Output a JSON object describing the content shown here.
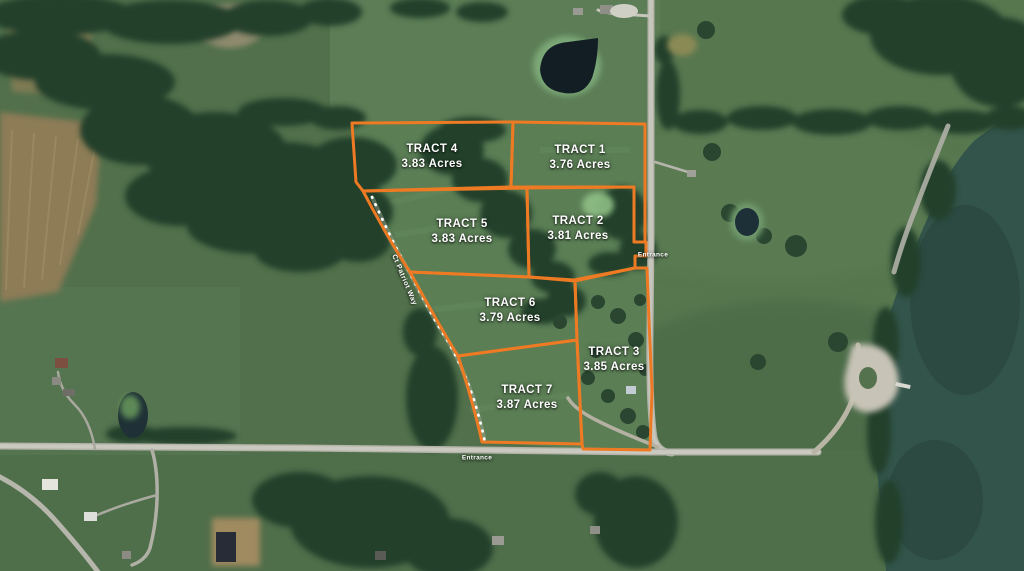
{
  "map": {
    "type": "aerial-plat-map",
    "colors": {
      "boundary": "#ee7a23",
      "label": "#ffffff",
      "water": "#33544b",
      "field": "#57774f"
    },
    "tracts": [
      {
        "name": "TRACT 1",
        "acres": "3.76 Acres"
      },
      {
        "name": "TRACT 2",
        "acres": "3.81 Acres"
      },
      {
        "name": "TRACT 3",
        "acres": "3.85 Acres"
      },
      {
        "name": "TRACT 4",
        "acres": "3.83 Acres"
      },
      {
        "name": "TRACT 5",
        "acres": "3.83 Acres"
      },
      {
        "name": "TRACT 6",
        "acres": "3.79 Acres"
      },
      {
        "name": "TRACT 7",
        "acres": "3.87 Acres"
      }
    ],
    "road_labels": {
      "entrance_east": "Entrance",
      "entrance_south": "Entrance",
      "lane": "Ct Patriot Way"
    }
  }
}
